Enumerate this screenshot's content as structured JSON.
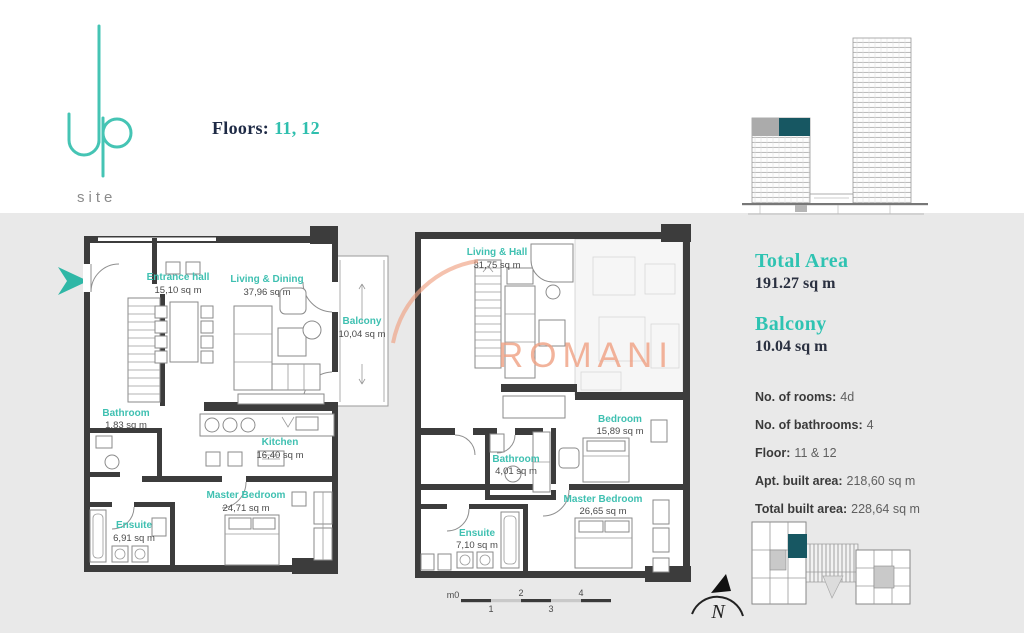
{
  "colors": {
    "accent_teal": "#3fc0b1",
    "heading_teal": "#2fc3b2",
    "dark_teal_highlight": "#175762",
    "navy": "#1e2a45",
    "watermark_salmon": "#f0a183",
    "band_gray": "#e9e9e9",
    "wall_dark": "#3c3c3c"
  },
  "logo": {
    "word": "up",
    "site": "site"
  },
  "header": {
    "floors_label": "Floors:",
    "floors_value": "11, 12"
  },
  "watermark": {
    "text": "ROMANIA"
  },
  "plans": [
    {
      "id": "lower-floor",
      "rooms": [
        {
          "name": "Entrance hall",
          "area": "15,10 sq m"
        },
        {
          "name": "Living & Dining",
          "area": "37,96 sq m"
        },
        {
          "name": "Balcony",
          "area": "10,04 sq m"
        },
        {
          "name": "Bathroom",
          "area": "1,83 sq m"
        },
        {
          "name": "Kitchen",
          "area": "16,40 sq m"
        },
        {
          "name": "Master Bedroom",
          "area": "24,71 sq m"
        },
        {
          "name": "Ensuite",
          "area": "6,91 sq m"
        }
      ]
    },
    {
      "id": "upper-floor",
      "rooms": [
        {
          "name": "Living & Hall",
          "area": "31,75 sq m"
        },
        {
          "name": "Bedroom",
          "area": "15,89 sq m"
        },
        {
          "name": "Bathroom",
          "area": "4,01 sq m"
        },
        {
          "name": "Master Bedroom",
          "area": "26,65 sq m"
        },
        {
          "name": "Ensuite",
          "area": "7,10 sq m"
        }
      ]
    }
  ],
  "summary": {
    "total_area_label": "Total Area",
    "total_area_value": "191.27 sq m",
    "balcony_label": "Balcony",
    "balcony_value": "10.04 sq m",
    "details": [
      {
        "label": "No. of rooms:",
        "value": "4d"
      },
      {
        "label": "No. of bathrooms:",
        "value": "4"
      },
      {
        "label": "Floor:",
        "value": "11 & 12"
      },
      {
        "label": "Apt. built area:",
        "value": "218,60 sq m"
      },
      {
        "label": "Total built area:",
        "value": "228,64 sq m"
      }
    ]
  },
  "scale_bar": {
    "zero": "m0",
    "marks": [
      "1",
      "2",
      "3",
      "4"
    ]
  },
  "compass": {
    "label": "N"
  }
}
